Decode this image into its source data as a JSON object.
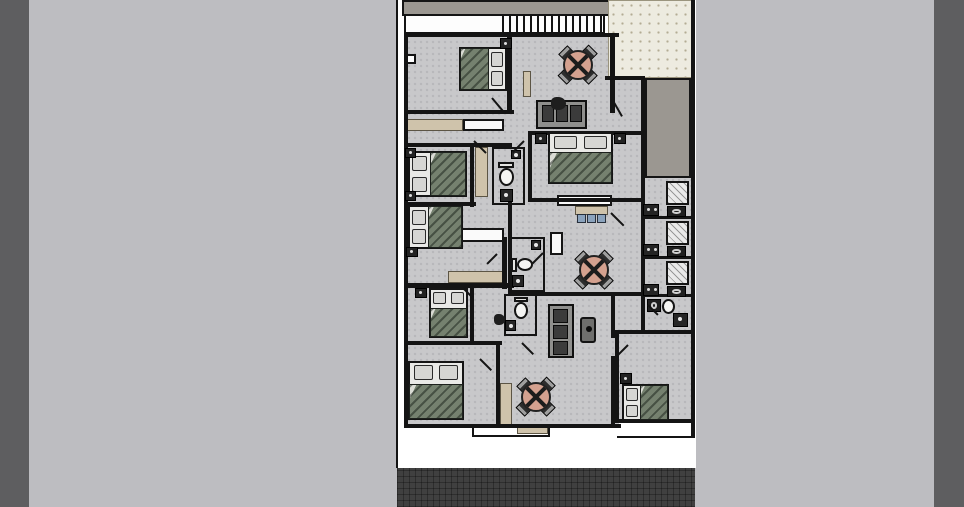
{
  "scene": {
    "width": 964,
    "height": 507,
    "colors": {
      "background": "#bdbdc1",
      "side_strip": "#5e5e60",
      "lot_white": "#ffffff",
      "street_dark": "#404040",
      "floor_gray": "#c8c8ca",
      "wall_black": "#141414",
      "slab_gray": "#9b9791",
      "courtyard_cream": "#edebe0",
      "wardrobe_tan": "#cfc3ab",
      "bed_blanket_sage": "#75816f",
      "table_salmon": "#d4a18f",
      "stool_blue": "#8ba3bd"
    }
  },
  "floorplan": {
    "side_strips": [
      [
        0,
        0,
        29,
        507
      ],
      [
        934,
        0,
        30,
        507
      ]
    ],
    "rects": [
      {
        "c": "lot",
        "n": "building-lot",
        "r": [
          396,
          0,
          300,
          468
        ]
      },
      {
        "c": "road",
        "n": "street",
        "r": [
          397,
          468,
          298,
          39
        ]
      },
      {
        "c": "floor",
        "n": "interior-floor",
        "r": [
          406,
          33,
          287,
          392
        ]
      },
      {
        "c": "slab",
        "n": "roof-slab",
        "r": [
          402,
          0,
          209,
          16
        ]
      },
      {
        "c": "courtyard",
        "n": "courtyard-patio",
        "r": [
          608,
          0,
          85,
          78
        ]
      },
      {
        "c": "patio",
        "n": "side-patio",
        "r": [
          645,
          78,
          46,
          100
        ]
      },
      {
        "c": "whitepatch",
        "n": "rear-setback",
        "r": [
          619,
          423,
          72,
          13
        ]
      },
      {
        "c": "tan",
        "n": "wardrobe",
        "r": [
          406,
          119,
          57,
          12
        ]
      },
      {
        "c": "dresser",
        "n": "dresser",
        "r": [
          463,
          119,
          41,
          12
        ]
      },
      {
        "c": "tan",
        "n": "wardrobe",
        "r": [
          475,
          147,
          13,
          50
        ]
      },
      {
        "c": "tan",
        "n": "wardrobe",
        "r": [
          448,
          271,
          55,
          12
        ]
      },
      {
        "c": "tan",
        "n": "wardrobe",
        "r": [
          500,
          383,
          12,
          42
        ]
      },
      {
        "c": "tan",
        "n": "wardrobe",
        "r": [
          523,
          71,
          8,
          26
        ]
      },
      {
        "c": "dresser",
        "n": "dresser",
        "r": [
          557,
          195,
          55,
          11
        ]
      },
      {
        "c": "dresser",
        "n": "dresser",
        "r": [
          446,
          228,
          58,
          14
        ]
      },
      {
        "c": "dresser",
        "n": "dresser",
        "r": [
          550,
          232,
          13,
          23
        ]
      },
      {
        "c": "tan",
        "n": "kitchen-counter",
        "r": [
          575,
          206,
          33,
          9
        ]
      },
      {
        "c": "stool",
        "n": "stool",
        "r": [
          577,
          214,
          9,
          9
        ]
      },
      {
        "c": "stool",
        "n": "stool",
        "r": [
          587,
          214,
          9,
          9
        ]
      },
      {
        "c": "stool",
        "n": "stool",
        "r": [
          597,
          214,
          9,
          9
        ]
      },
      {
        "c": "porch",
        "n": "entry-step",
        "r": [
          472,
          424,
          78,
          13
        ]
      },
      {
        "c": "tan",
        "n": "doormat",
        "r": [
          517,
          427,
          31,
          7
        ]
      },
      {
        "c": "window",
        "n": "window",
        "r": [
          406,
          54,
          10,
          10
        ]
      }
    ],
    "stairs": {
      "r": [
        404,
        14,
        201,
        20
      ],
      "treads_area": [
        96,
        0,
        105,
        16
      ],
      "tread_count": 15
    },
    "walls": [
      [
        396,
        0,
        2,
        468
      ],
      [
        404,
        33,
        4,
        395
      ],
      [
        404,
        33,
        215,
        4
      ],
      [
        691,
        0,
        4,
        437
      ],
      [
        404,
        424,
        217,
        4
      ],
      [
        615,
        419,
        78,
        4
      ],
      [
        617,
        436,
        78,
        2
      ],
      [
        507,
        33,
        5,
        80
      ],
      [
        404,
        110,
        110,
        4
      ],
      [
        404,
        143,
        108,
        4
      ],
      [
        470,
        147,
        4,
        60
      ],
      [
        404,
        202,
        72,
        4
      ],
      [
        404,
        283,
        110,
        5
      ],
      [
        502,
        237,
        5,
        52
      ],
      [
        528,
        131,
        113,
        4
      ],
      [
        528,
        131,
        4,
        71
      ],
      [
        528,
        198,
        117,
        4
      ],
      [
        610,
        33,
        5,
        80
      ],
      [
        641,
        78,
        4,
        254
      ],
      [
        605,
        76,
        40,
        4
      ],
      [
        645,
        78,
        2,
        100
      ],
      [
        508,
        202,
        4,
        94
      ],
      [
        508,
        292,
        135,
        4
      ],
      [
        611,
        296,
        4,
        42
      ],
      [
        611,
        356,
        4,
        70
      ],
      [
        615,
        330,
        78,
        4
      ],
      [
        615,
        334,
        4,
        88
      ],
      [
        641,
        216,
        50,
        3
      ],
      [
        641,
        256,
        50,
        3
      ],
      [
        641,
        294,
        50,
        3
      ],
      [
        404,
        341,
        98,
        4
      ],
      [
        496,
        345,
        4,
        83
      ],
      [
        470,
        288,
        4,
        55
      ]
    ],
    "bath_outlines": [
      [
        492,
        147,
        33,
        58
      ],
      [
        508,
        237,
        37,
        55
      ],
      [
        504,
        294,
        33,
        42
      ],
      [
        641,
        294,
        52,
        40
      ]
    ],
    "beds": [
      {
        "r": [
          459,
          47,
          48,
          44
        ],
        "dir": "right"
      },
      {
        "r": [
          408,
          151,
          59,
          46
        ],
        "dir": "left"
      },
      {
        "r": [
          408,
          205,
          55,
          44
        ],
        "dir": "left"
      },
      {
        "r": [
          548,
          132,
          65,
          52
        ],
        "dir": "top"
      },
      {
        "r": [
          429,
          288,
          39,
          50
        ],
        "dir": "top"
      },
      {
        "r": [
          408,
          361,
          56,
          59
        ],
        "dir": "top"
      },
      {
        "r": [
          622,
          384,
          47,
          37
        ],
        "dir": "left"
      }
    ],
    "side_tables": [
      [
        500,
        38,
        12,
        11
      ],
      [
        405,
        148,
        11,
        10
      ],
      [
        405,
        191,
        11,
        10
      ],
      [
        406,
        247,
        12,
        10
      ],
      [
        415,
        288,
        12,
        10
      ],
      [
        620,
        373,
        12,
        11
      ],
      [
        535,
        133,
        12,
        11
      ],
      [
        614,
        133,
        12,
        11
      ]
    ],
    "round_tables": [
      [
        578,
        65
      ],
      [
        594,
        270
      ],
      [
        536,
        397
      ]
    ],
    "sofas": [
      {
        "r": [
          536,
          100,
          51,
          29
        ],
        "dir": "h"
      },
      {
        "r": [
          548,
          304,
          26,
          54
        ],
        "dir": "v"
      }
    ],
    "decor": [
      [
        551,
        97,
        15,
        13
      ],
      [
        494,
        314,
        11,
        11
      ]
    ],
    "tv_units": [
      [
        580,
        317,
        16,
        26
      ]
    ],
    "fixtures": [
      {
        "t": "tank",
        "r": [
          498,
          162,
          16,
          6
        ]
      },
      {
        "t": "oval",
        "r": [
          499,
          168,
          15,
          18
        ]
      },
      {
        "t": "sinksq",
        "r": [
          500,
          189,
          13,
          13
        ]
      },
      {
        "t": "sinksq",
        "r": [
          511,
          150,
          10,
          9
        ]
      },
      {
        "t": "tank",
        "r": [
          511,
          258,
          6,
          14
        ]
      },
      {
        "t": "oval",
        "r": [
          517,
          258,
          16,
          13
        ]
      },
      {
        "t": "sinksq",
        "r": [
          512,
          275,
          12,
          12
        ]
      },
      {
        "t": "sinksq",
        "r": [
          531,
          240,
          10,
          10
        ]
      },
      {
        "t": "tank",
        "r": [
          514,
          297,
          14,
          5
        ]
      },
      {
        "t": "oval",
        "r": [
          514,
          302,
          14,
          17
        ]
      },
      {
        "t": "sinksq",
        "r": [
          505,
          320,
          11,
          11
        ]
      },
      {
        "t": "wc",
        "r": [
          647,
          299,
          14,
          13
        ]
      },
      {
        "t": "oval",
        "r": [
          662,
          299,
          13,
          15
        ]
      },
      {
        "t": "sinksq",
        "r": [
          673,
          313,
          15,
          14
        ]
      },
      {
        "t": "shower",
        "r": [
          666,
          181,
          23,
          24
        ]
      },
      {
        "t": "wc",
        "r": [
          667,
          206,
          19,
          11
        ]
      },
      {
        "t": "bench",
        "r": [
          643,
          204,
          16,
          12
        ]
      },
      {
        "t": "shower",
        "r": [
          666,
          221,
          23,
          24
        ]
      },
      {
        "t": "wc",
        "r": [
          667,
          246,
          19,
          11
        ]
      },
      {
        "t": "bench",
        "r": [
          643,
          244,
          16,
          12
        ]
      },
      {
        "t": "shower",
        "r": [
          666,
          261,
          23,
          24
        ]
      },
      {
        "t": "wc",
        "r": [
          667,
          286,
          19,
          11
        ]
      },
      {
        "t": "bench",
        "r": [
          643,
          284,
          16,
          12
        ]
      }
    ],
    "doors": [
      [
        492,
        97,
        20,
        50
      ],
      [
        474,
        140,
        17,
        45
      ],
      [
        524,
        140,
        16,
        135
      ],
      [
        612,
        98,
        20,
        60
      ],
      [
        611,
        212,
        18,
        45
      ],
      [
        543,
        252,
        15,
        135
      ],
      [
        522,
        342,
        16,
        45
      ],
      [
        628,
        344,
        16,
        135
      ],
      [
        648,
        304,
        14,
        45
      ],
      [
        462,
        286,
        14,
        45
      ],
      [
        480,
        358,
        16,
        45
      ],
      [
        497,
        253,
        14,
        135
      ]
    ],
    "fixture_names": {
      "shower": "shower",
      "wc": "toilet",
      "bench": "bath-counter",
      "oval": "toilet-bowl",
      "tank": "toilet-cistern",
      "sinksq": "sink"
    }
  }
}
